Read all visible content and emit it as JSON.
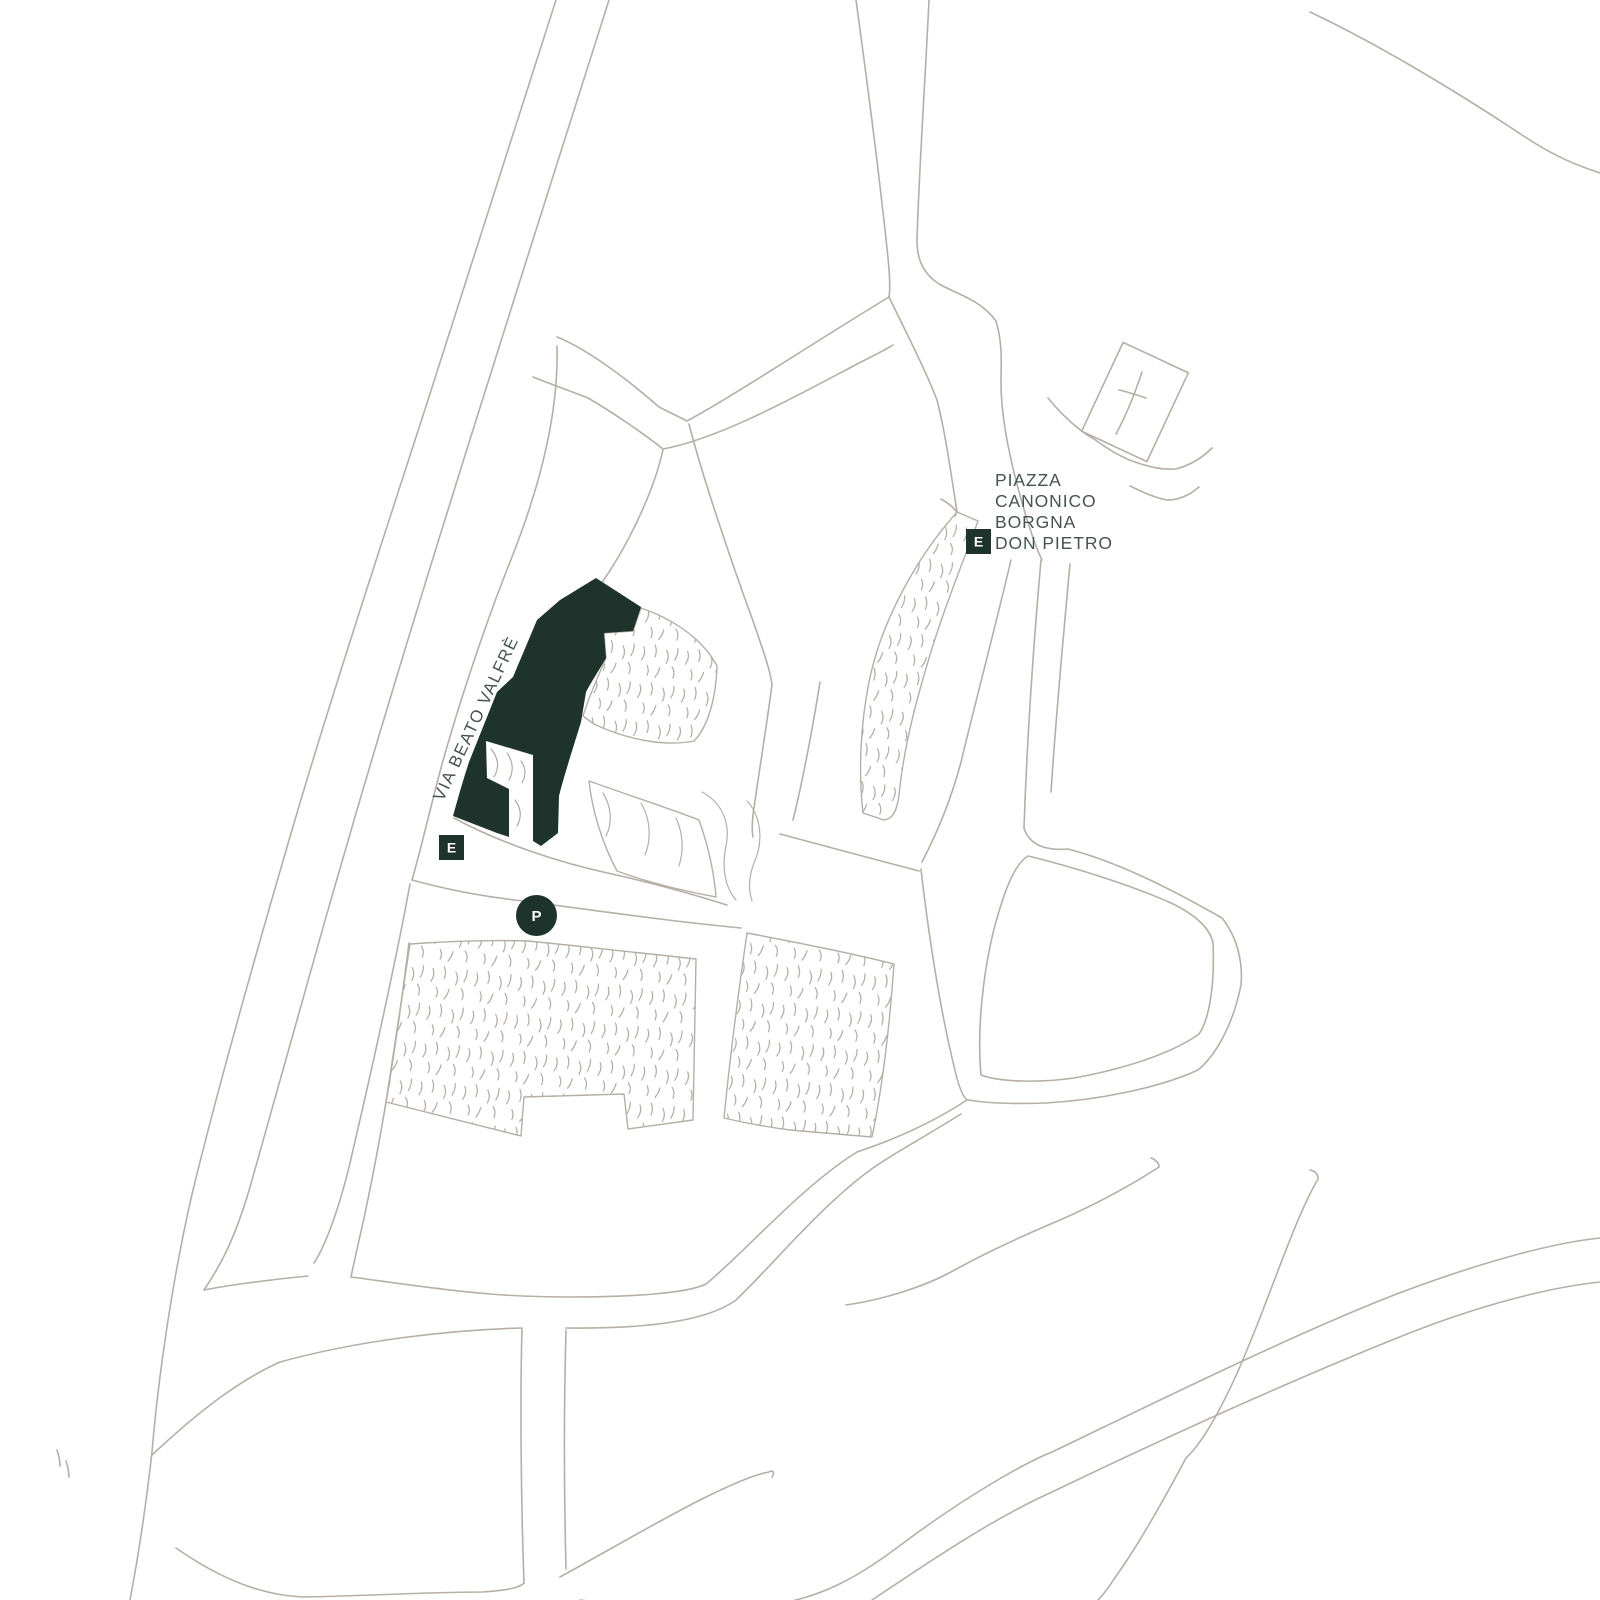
{
  "map": {
    "description": "hand-drawn site plan map",
    "street_label": "VIA BEATO VALFRÈ",
    "piazza_label": [
      "PIAZZA",
      "CANONICO",
      "BORGNA",
      "DON PIETRO"
    ],
    "markers": [
      {
        "id": "entrance-piazza",
        "label": "E",
        "shape": "square"
      },
      {
        "id": "entrance-via-beato-valfre",
        "label": "E",
        "shape": "square"
      },
      {
        "id": "parking",
        "label": "P",
        "shape": "circle"
      }
    ],
    "church_symbol": "cross-icon",
    "theme": {
      "paper": "#ffffff",
      "line": "#b5afa5",
      "tick": "#a9a399",
      "ink": "#1e332b",
      "label": "#46544e",
      "badge-text": "#ffffff"
    }
  }
}
